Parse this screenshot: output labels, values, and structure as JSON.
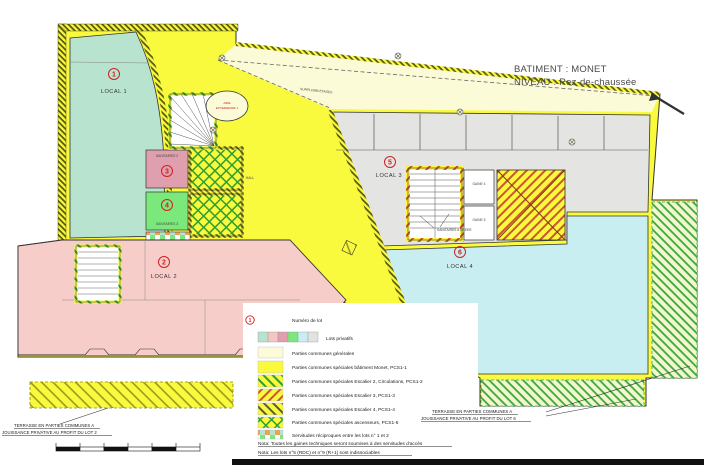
{
  "header": {
    "building": "BATIMENT : MONET",
    "level": "NIVEAU : Rez-de-chaussée"
  },
  "plan": {
    "lots": [
      {
        "num": "1",
        "label": "LOCAL 1"
      },
      {
        "num": "2",
        "label": "LOCAL 2"
      },
      {
        "num": "3",
        "label": "SANITAIRES 2"
      },
      {
        "num": "4",
        "label": "SANITAIRES 3"
      },
      {
        "num": "5",
        "label": "LOCAL 3"
      },
      {
        "num": "6",
        "label": "LOCAL 4"
      }
    ],
    "rooms": {
      "hall": "HALL",
      "gaine4": "GAINE 4",
      "gaine5": "GAINE 5",
      "surplomb": "SURPLOMB ETAGES",
      "aire_line1": "AIRE",
      "aire_line2": "EXTERIEURE 1",
      "sanitaires_a_creer": "SANITAIRES A CREER"
    },
    "terrace_left": {
      "line1": "TERRASSE EN PARTIES COMMUNES A",
      "line2": "JOUISSANCE PRIVATIVE AU PROFIT DU  LOT 2"
    },
    "terrace_right": {
      "line1": "TERRASSE EN PARTIES COMMUNES A",
      "line2": "JOUISSANCE PRIVATIVE AU PROFIT DU  LOT 6"
    }
  },
  "legend": {
    "sample_lot_number": "1",
    "items": [
      {
        "label": "Numéro de lot"
      },
      {
        "label": "Lots privatifs"
      },
      {
        "label": "Parties communes générales"
      },
      {
        "label": "Parties communes spéciales bâtiment Monet, PCS1-1"
      },
      {
        "label": "Parties communes spéciales Escalier 2, Circulations,  PCS1-2"
      },
      {
        "label": "Parties communes spéciales Escalier 3, PCS1-3"
      },
      {
        "label": "Parties communes spéciales Escalier 4, PCS1-4"
      },
      {
        "label": "Parties communes spéciales ascenseurs, PCS1-5"
      },
      {
        "label": "Servitudes réciproques entre les lots n° 1 et 2"
      }
    ],
    "notes": [
      "Nota: Toutes les gaines techniques seront soumises à des servitudes d'accès",
      "Nota: Les lots n°5 (RDC) et n°9 (R+1) sont indissociables"
    ]
  },
  "colors": {
    "common_yellow": "#f9f93e",
    "general_pale_yellow": "#fbfbd8",
    "lot1_teal": "#b7e3cf",
    "lot2_pink": "#f7cdc9",
    "sanitaires2_mauve": "#df9fae",
    "sanitaires3_green": "#7be87b",
    "lot3_gray": "#e4e4e2",
    "lot4_cyan": "#c8eef2",
    "hatch_green": "#2f9e2f",
    "hatch_red": "#cc5533",
    "marker_red": "#cc2222"
  }
}
